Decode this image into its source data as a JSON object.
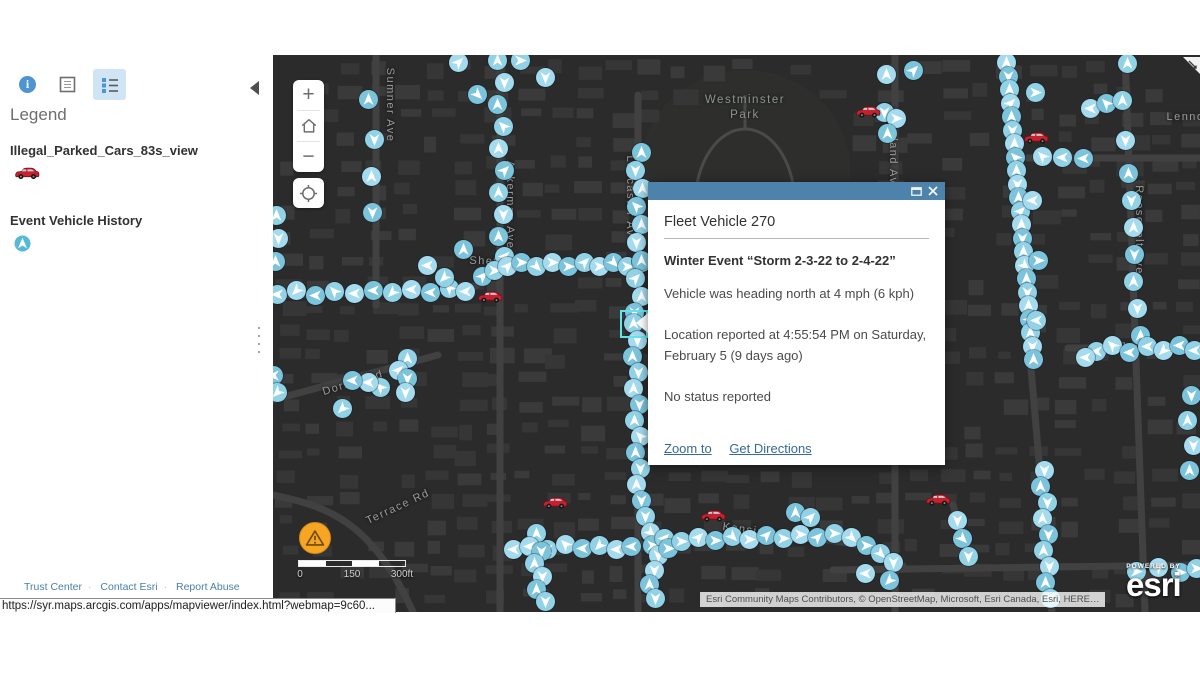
{
  "browser": {
    "status_url": "https://syr.maps.arcgis.com/apps/mapviewer/index.html?webmap=9c60..."
  },
  "panel": {
    "toolbar": {
      "info": "info-icon",
      "table": "data-table-icon",
      "legend": "legend-list-icon",
      "collapse": "collapse-panel-arrow"
    },
    "legend_title": "Legend",
    "layers": [
      {
        "name": "Illegal_Parked_Cars_83s_view",
        "symbol": "red-car-icon"
      },
      {
        "name": "Event Vehicle History",
        "symbol": "direction-arrow-marker"
      }
    ],
    "footer_links": [
      "Trust Center",
      "Contact Esri",
      "Report Abuse"
    ]
  },
  "popup": {
    "title": "Fleet Vehicle 270",
    "heading": "Winter Event “Storm 2-3-22 to 2-4-22”",
    "body_lines": [
      "Vehicle was heading north at 4 mph (6 kph)",
      "Location reported at 4:55:54 PM on Saturday, February 5 (9 days ago)",
      "No status reported"
    ],
    "links": {
      "zoom_to": "Zoom to",
      "get_directions": "Get Directions"
    }
  },
  "map": {
    "controls": {
      "zoom_in": "+",
      "zoom_out": "−"
    },
    "scalebar": {
      "labels": [
        "0",
        "150",
        "300ft"
      ]
    },
    "attribution": "Esri Community Maps Contributors, © OpenStreetMap, Microsoft, Esri Canada, Esri, HERE…",
    "logo": {
      "powered_by": "POWERED BY",
      "brand": "esri"
    },
    "park_label": {
      "text_line1": "Westminster",
      "text_line2": "Park",
      "x": 472,
      "y": 38
    },
    "street_labels": [
      {
        "text": "Sumner Ave",
        "x": 117,
        "y": 50,
        "rot": 90
      },
      {
        "text": "Ackerman Ave",
        "x": 237,
        "y": 150,
        "rot": 90
      },
      {
        "text": "Shefford St",
        "x": 232,
        "y": 207,
        "rot": 2
      },
      {
        "text": "Dorset Rd",
        "x": 80,
        "y": 328,
        "rot": -17
      },
      {
        "text": "Terrace Rd",
        "x": 125,
        "y": 452,
        "rot": -25
      },
      {
        "text": "Lancaster Ave",
        "x": 357,
        "y": 145,
        "rot": 90
      },
      {
        "text": "Maryland Ave",
        "x": 620,
        "y": 95,
        "rot": 90
      },
      {
        "text": "Westcott St",
        "x": 737,
        "y": 70,
        "rot": 84
      },
      {
        "text": "Westcott St",
        "x": 751,
        "y": 205,
        "rot": 84
      },
      {
        "text": "Roosevelt Ave",
        "x": 866,
        "y": 175,
        "rot": 90
      },
      {
        "text": "Lennox",
        "x": 916,
        "y": 62,
        "rot": 0
      },
      {
        "text": "Jerome St",
        "x": 879,
        "y": 293,
        "rot": 2
      },
      {
        "text": "Kensington Rd",
        "x": 495,
        "y": 478,
        "rot": 8
      }
    ],
    "selected_marker": {
      "x": 360,
      "y": 268
    },
    "markers": [
      [
        224,
        5,
        0
      ],
      [
        231,
        27,
        180
      ],
      [
        224,
        49,
        0
      ],
      [
        230,
        71,
        315
      ],
      [
        225,
        93,
        0
      ],
      [
        231,
        115,
        45
      ],
      [
        225,
        137,
        0
      ],
      [
        230,
        159,
        180
      ],
      [
        225,
        181,
        0
      ],
      [
        231,
        201,
        270
      ],
      [
        185,
        7,
        45
      ],
      [
        204,
        39,
        135
      ],
      [
        247,
        5,
        90
      ],
      [
        272,
        22,
        180
      ],
      [
        95,
        44,
        0
      ],
      [
        101,
        84,
        180
      ],
      [
        98,
        121,
        0
      ],
      [
        99,
        157,
        180
      ],
      [
        3,
        160,
        0
      ],
      [
        5,
        183,
        180
      ],
      [
        2,
        206,
        0
      ],
      [
        4,
        239,
        270
      ],
      [
        23,
        235,
        225
      ],
      [
        42,
        240,
        270
      ],
      [
        61,
        236,
        315
      ],
      [
        81,
        238,
        270
      ],
      [
        100,
        235,
        270
      ],
      [
        119,
        237,
        225
      ],
      [
        138,
        234,
        270
      ],
      [
        157,
        237,
        270
      ],
      [
        176,
        233,
        315
      ],
      [
        192,
        236,
        270
      ],
      [
        190,
        194,
        0
      ],
      [
        171,
        222,
        225
      ],
      [
        154,
        210,
        270
      ],
      [
        209,
        221,
        45
      ],
      [
        221,
        215,
        90
      ],
      [
        234,
        211,
        45
      ],
      [
        248,
        207,
        90
      ],
      [
        263,
        211,
        135
      ],
      [
        279,
        207,
        90
      ],
      [
        295,
        211,
        90
      ],
      [
        311,
        207,
        45
      ],
      [
        326,
        211,
        90
      ],
      [
        340,
        207,
        135
      ],
      [
        354,
        211,
        90
      ],
      [
        368,
        207,
        45
      ],
      [
        368,
        97,
        0
      ],
      [
        362,
        115,
        180
      ],
      [
        369,
        133,
        0
      ],
      [
        363,
        151,
        315
      ],
      [
        368,
        169,
        0
      ],
      [
        363,
        187,
        180
      ],
      [
        368,
        205,
        0
      ],
      [
        362,
        223,
        45
      ],
      [
        368,
        241,
        0
      ],
      [
        361,
        257,
        180
      ],
      [
        360,
        268,
        0
      ],
      [
        364,
        285,
        180
      ],
      [
        359,
        301,
        0
      ],
      [
        365,
        317,
        180
      ],
      [
        360,
        333,
        0
      ],
      [
        366,
        349,
        180
      ],
      [
        361,
        365,
        0
      ],
      [
        367,
        381,
        315
      ],
      [
        362,
        397,
        0
      ],
      [
        367,
        413,
        180
      ],
      [
        363,
        429,
        0
      ],
      [
        368,
        445,
        180
      ],
      [
        372,
        461,
        180
      ],
      [
        377,
        477,
        135
      ],
      [
        379,
        490,
        90
      ],
      [
        391,
        483,
        45
      ],
      [
        385,
        500,
        180
      ],
      [
        395,
        493,
        90
      ],
      [
        408,
        486,
        90
      ],
      [
        425,
        482,
        45
      ],
      [
        442,
        485,
        90
      ],
      [
        459,
        481,
        135
      ],
      [
        476,
        484,
        90
      ],
      [
        493,
        480,
        45
      ],
      [
        510,
        483,
        90
      ],
      [
        527,
        479,
        90
      ],
      [
        544,
        482,
        45
      ],
      [
        561,
        478,
        90
      ],
      [
        578,
        482,
        135
      ],
      [
        593,
        490,
        90
      ],
      [
        607,
        498,
        135
      ],
      [
        620,
        507,
        180
      ],
      [
        522,
        457,
        0
      ],
      [
        537,
        462,
        45
      ],
      [
        240,
        494,
        270
      ],
      [
        257,
        490,
        225
      ],
      [
        274,
        494,
        270
      ],
      [
        292,
        489,
        315
      ],
      [
        309,
        493,
        270
      ],
      [
        326,
        490,
        225
      ],
      [
        343,
        494,
        270
      ],
      [
        358,
        491,
        270
      ],
      [
        263,
        478,
        0
      ],
      [
        256,
        491,
        270
      ],
      [
        268,
        496,
        180
      ],
      [
        261,
        508,
        0
      ],
      [
        269,
        521,
        180
      ],
      [
        263,
        534,
        0
      ],
      [
        272,
        546,
        180
      ],
      [
        381,
        515,
        180
      ],
      [
        376,
        529,
        0
      ],
      [
        382,
        543,
        180
      ],
      [
        733,
        7,
        0
      ],
      [
        735,
        21,
        180
      ],
      [
        736,
        34,
        0
      ],
      [
        737,
        48,
        45
      ],
      [
        738,
        61,
        0
      ],
      [
        739,
        75,
        180
      ],
      [
        741,
        88,
        0
      ],
      [
        742,
        102,
        315
      ],
      [
        743,
        115,
        0
      ],
      [
        744,
        129,
        180
      ],
      [
        745,
        142,
        0
      ],
      [
        747,
        156,
        45
      ],
      [
        748,
        169,
        0
      ],
      [
        749,
        183,
        180
      ],
      [
        750,
        196,
        0
      ],
      [
        751,
        210,
        135
      ],
      [
        753,
        223,
        0
      ],
      [
        754,
        237,
        180
      ],
      [
        755,
        250,
        0
      ],
      [
        756,
        264,
        45
      ],
      [
        757,
        277,
        0
      ],
      [
        759,
        291,
        180
      ],
      [
        760,
        304,
        0
      ],
      [
        762,
        37,
        90
      ],
      [
        759,
        145,
        270
      ],
      [
        765,
        205,
        90
      ],
      [
        763,
        265,
        270
      ],
      [
        771,
        415,
        180
      ],
      [
        767,
        431,
        0
      ],
      [
        774,
        447,
        180
      ],
      [
        769,
        463,
        0
      ],
      [
        775,
        479,
        180
      ],
      [
        770,
        495,
        0
      ],
      [
        776,
        511,
        180
      ],
      [
        772,
        527,
        0
      ],
      [
        777,
        543,
        180
      ],
      [
        684,
        465,
        180
      ],
      [
        689,
        483,
        135
      ],
      [
        695,
        501,
        180
      ],
      [
        613,
        19,
        0
      ],
      [
        640,
        15,
        45
      ],
      [
        611,
        57,
        180
      ],
      [
        623,
        63,
        90
      ],
      [
        614,
        78,
        0
      ],
      [
        854,
        8,
        0
      ],
      [
        817,
        53,
        270
      ],
      [
        833,
        48,
        315
      ],
      [
        849,
        45,
        0
      ],
      [
        852,
        85,
        180
      ],
      [
        810,
        103,
        270
      ],
      [
        789,
        102,
        270
      ],
      [
        769,
        101,
        315
      ],
      [
        855,
        118,
        0
      ],
      [
        858,
        145,
        180
      ],
      [
        860,
        172,
        0
      ],
      [
        861,
        199,
        180
      ],
      [
        860,
        226,
        0
      ],
      [
        864,
        253,
        180
      ],
      [
        867,
        280,
        0
      ],
      [
        823,
        296,
        270
      ],
      [
        839,
        290,
        315
      ],
      [
        856,
        297,
        270
      ],
      [
        874,
        291,
        270
      ],
      [
        890,
        295,
        225
      ],
      [
        906,
        290,
        270
      ],
      [
        921,
        295,
        270
      ],
      [
        812,
        302,
        270
      ],
      [
        918,
        340,
        180
      ],
      [
        914,
        365,
        0
      ],
      [
        920,
        390,
        180
      ],
      [
        916,
        415,
        0
      ],
      [
        863,
        516,
        90
      ],
      [
        885,
        512,
        45
      ],
      [
        907,
        517,
        90
      ],
      [
        923,
        513,
        90
      ],
      [
        592,
        518,
        270
      ],
      [
        616,
        525,
        225
      ],
      [
        134,
        303,
        0
      ],
      [
        125,
        315,
        45
      ],
      [
        134,
        323,
        180
      ],
      [
        107,
        332,
        315
      ],
      [
        95,
        327,
        270
      ],
      [
        79,
        325,
        270
      ],
      [
        69,
        353,
        225
      ],
      [
        132,
        337,
        180
      ],
      [
        0,
        320,
        270
      ],
      [
        4,
        337,
        225
      ]
    ],
    "cars": [
      [
        595,
        57
      ],
      [
        763,
        83
      ],
      [
        217,
        242
      ],
      [
        282,
        448
      ],
      [
        440,
        461
      ],
      [
        665,
        445
      ]
    ]
  }
}
